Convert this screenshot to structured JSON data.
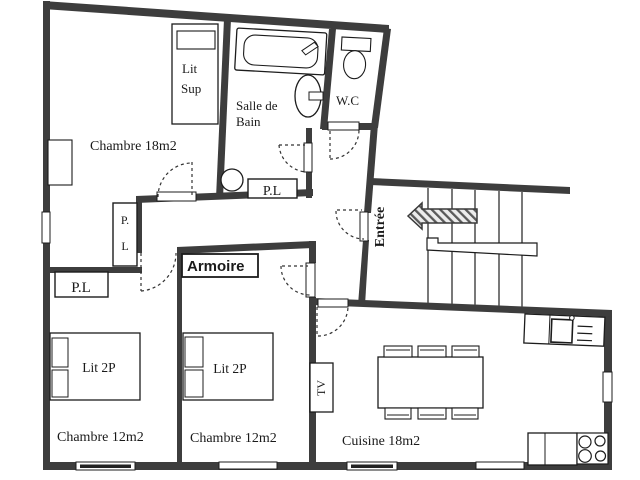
{
  "plan_title": "Apartment floor plan",
  "colors": {
    "wall": "#3d3d3d",
    "line": "#1c1c1c",
    "stair_line": "#4a4a4a"
  },
  "rooms": {
    "chambre18": {
      "label": "Chambre 18m2"
    },
    "salle_de_bain": {
      "line1": "Salle de",
      "line2": "Bain"
    },
    "wc": {
      "label": "W.C"
    },
    "entree": {
      "label": "Entrée"
    },
    "chambre12_left": {
      "label": "Chambre 12m2"
    },
    "chambre12_right": {
      "label": "Chambre 12m2"
    },
    "cuisine": {
      "label": "Cuisine 18m2"
    }
  },
  "closets": {
    "pl_hall_line1": "P.",
    "pl_hall_line2": "L",
    "pl_bath": "P.L",
    "pl_bedroom": "P.L",
    "armoire": "Armoire"
  },
  "furniture": {
    "lit_sup_line1": "Lit",
    "lit_sup_line2": "Sup",
    "lit_2p_left": "Lit 2P",
    "lit_2p_right": "Lit 2P",
    "tv": "TV"
  }
}
